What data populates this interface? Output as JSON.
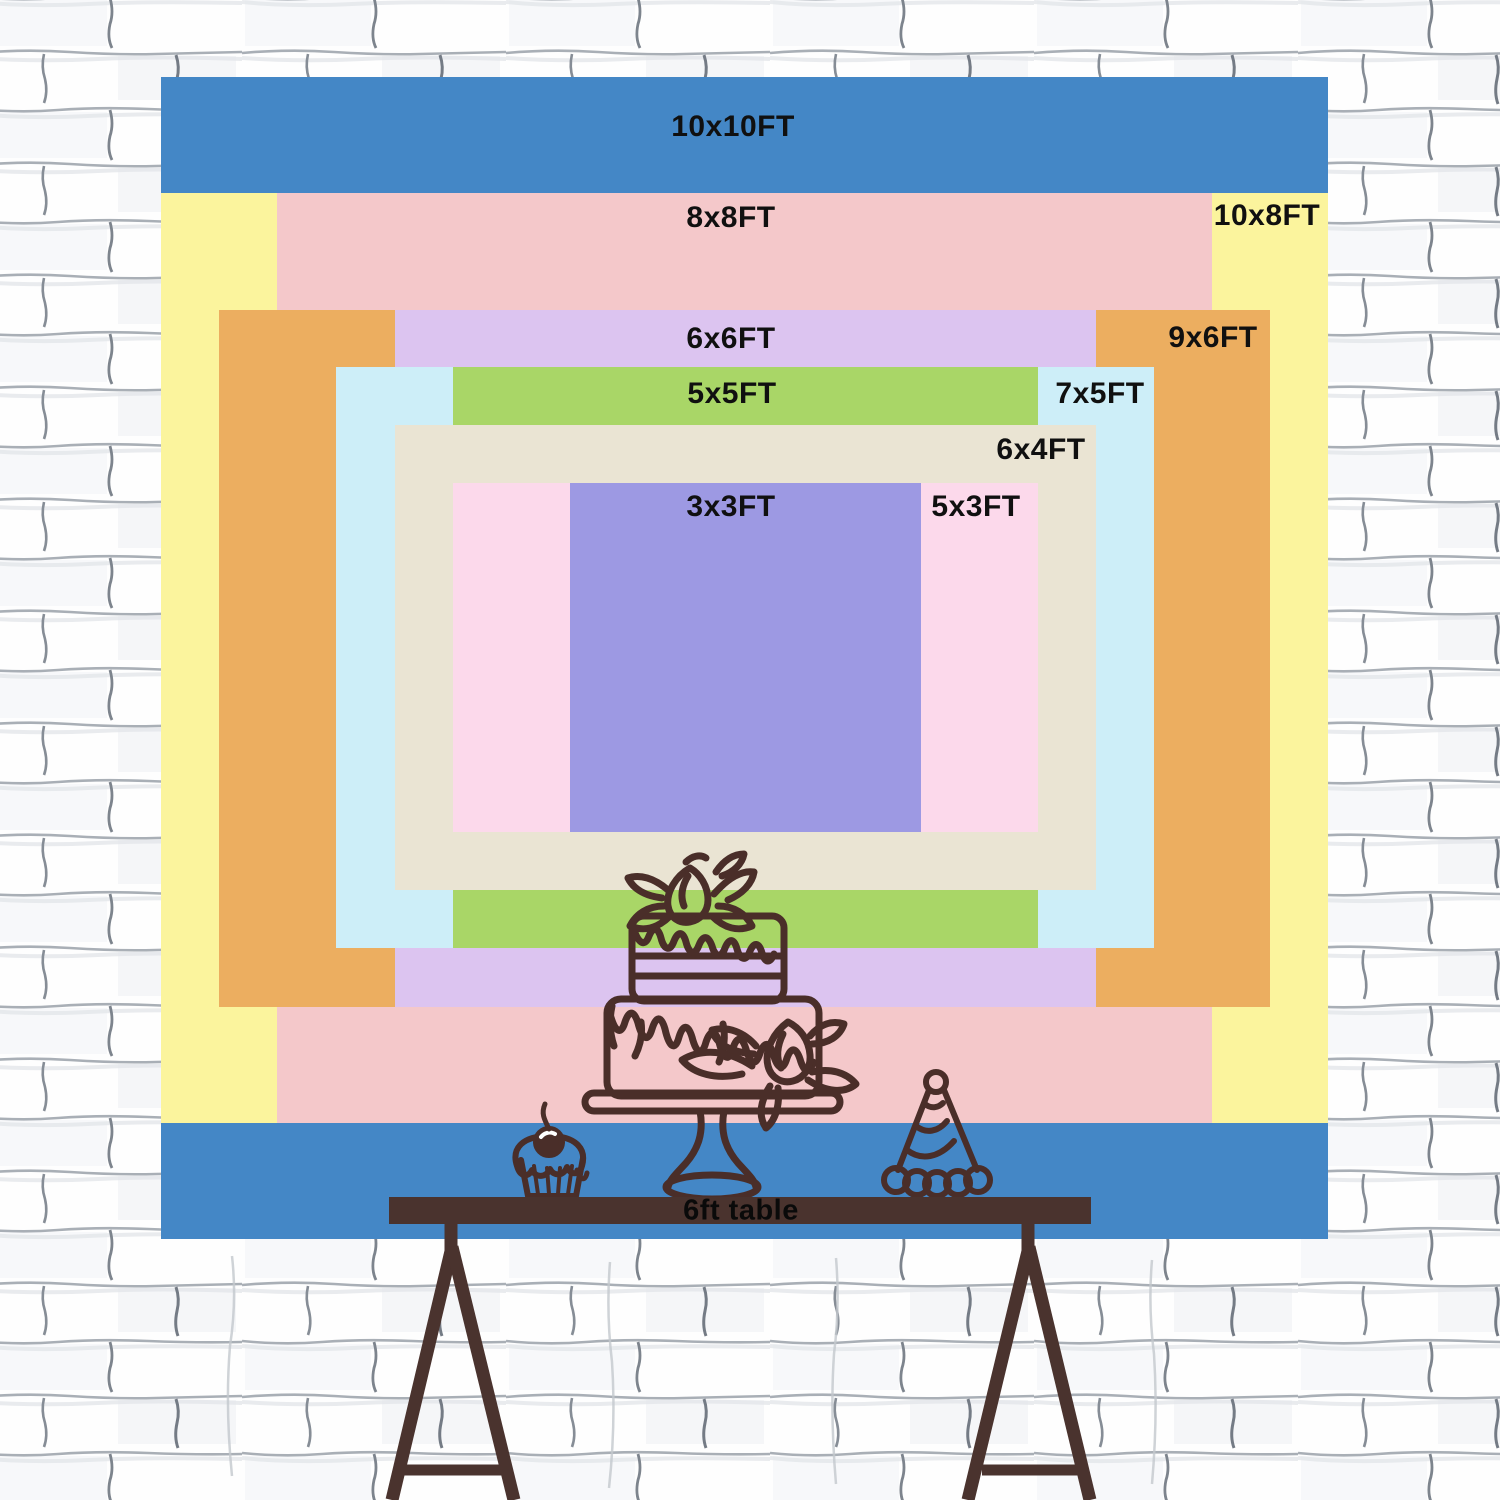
{
  "page": {
    "width": 1500,
    "height": 1500,
    "background": "#ffffff"
  },
  "wall": {
    "description": "white sketched brick wall",
    "brick_fill": "#fefefe",
    "mortar_line_color": "#9aa1a9",
    "mortar_shadow_color": "#e3e6ea",
    "joint_color": "#7d848d"
  },
  "backdrop": {
    "label_color": "#101010",
    "label_font_size": 30,
    "sizes": [
      {
        "id": "10x10",
        "label": "10x10FT",
        "color": "#4487c6",
        "x": 161,
        "y": 77,
        "w": 1167,
        "h": 1162,
        "label_x": 733,
        "label_y": 127
      },
      {
        "id": "10x8",
        "label": "10x8FT",
        "color": "#fbf49d",
        "x": 161,
        "y": 193,
        "w": 1167,
        "h": 930,
        "label_x": 1267,
        "label_y": 216
      },
      {
        "id": "8x8",
        "label": "8x8FT",
        "color": "#f4c8ca",
        "x": 277,
        "y": 193,
        "w": 935,
        "h": 930,
        "label_x": 731,
        "label_y": 218
      },
      {
        "id": "9x6",
        "label": "9x6FT",
        "color": "#ecae60",
        "x": 219,
        "y": 310,
        "w": 1051,
        "h": 697,
        "label_x": 1213,
        "label_y": 338
      },
      {
        "id": "6x6",
        "label": "6x6FT",
        "color": "#dcc4f0",
        "x": 395,
        "y": 310,
        "w": 701,
        "h": 697,
        "label_x": 731,
        "label_y": 339
      },
      {
        "id": "7x5",
        "label": "7x5FT",
        "color": "#cdeef8",
        "x": 336,
        "y": 367,
        "w": 818,
        "h": 581,
        "label_x": 1100,
        "label_y": 394
      },
      {
        "id": "5x5",
        "label": "5x5FT",
        "color": "#a9d667",
        "x": 453,
        "y": 367,
        "w": 585,
        "h": 581,
        "label_x": 732,
        "label_y": 394
      },
      {
        "id": "6x4",
        "label": "6x4FT",
        "color": "#eae4d3",
        "x": 395,
        "y": 425,
        "w": 701,
        "h": 465,
        "label_x": 1041,
        "label_y": 450
      },
      {
        "id": "5x3",
        "label": "5x3FT",
        "color": "#fcd9eb",
        "x": 453,
        "y": 483,
        "w": 585,
        "h": 349,
        "label_x": 976,
        "label_y": 507
      },
      {
        "id": "3x3",
        "label": "3x3FT",
        "color": "#9d99e3",
        "x": 570,
        "y": 483,
        "w": 351,
        "h": 349,
        "label_x": 731,
        "label_y": 507
      }
    ]
  },
  "table": {
    "label": "6ft table",
    "label_x": 741,
    "label_y": 1211,
    "color": "#4a332e",
    "top": {
      "x": 389,
      "y": 1197,
      "w": 702,
      "h": 27
    }
  },
  "line_art": {
    "stroke": "#4a2e29",
    "items": [
      "birthday-cake on stand",
      "cupcake with cherry",
      "striped party hat",
      "trestle table legs"
    ]
  }
}
